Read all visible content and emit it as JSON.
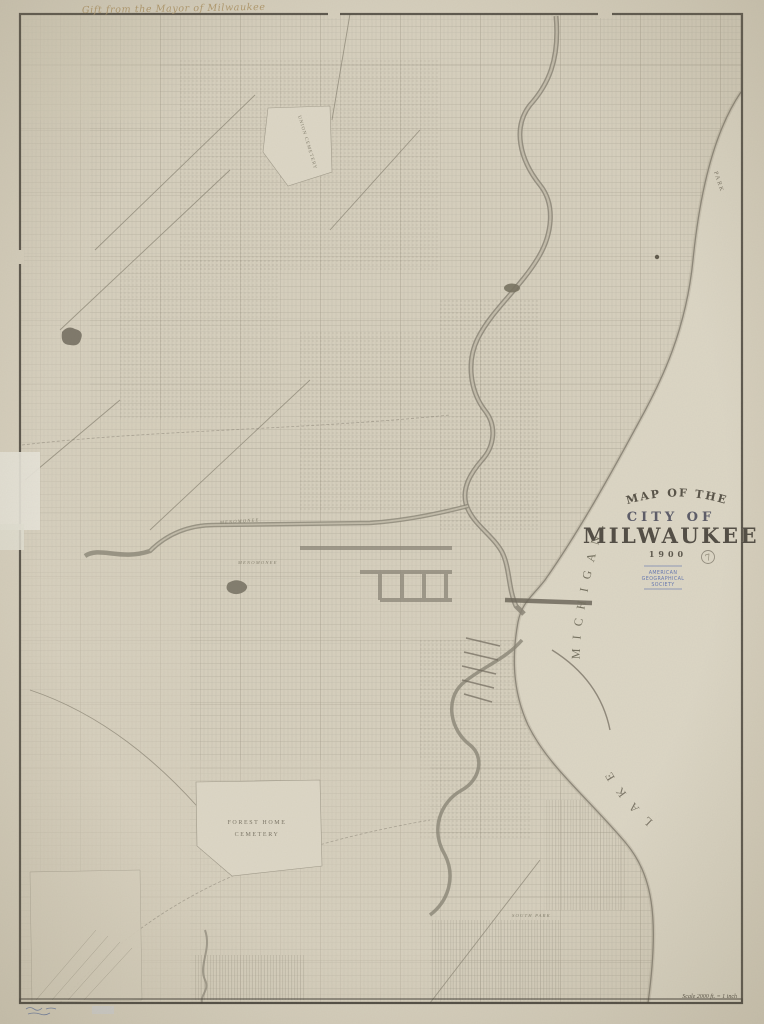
{
  "map": {
    "inscription": "Gift from the Mayor of Milwaukee",
    "title": {
      "arc": "MAP OF THE",
      "line2": "CITY OF",
      "line3": "MILWAUKEE",
      "year": "1900"
    },
    "stamp": {
      "line1": "AMERICAN",
      "line2": "GEOGRAPHICAL",
      "line3": "SOCIETY"
    },
    "pencil_number": "7",
    "scale_note": "Scale 2000 ft. = 1 inch",
    "water_labels": {
      "lake": "LAKE",
      "michigan": "MICHIGAN.",
      "park": "PARK"
    },
    "place_labels": {
      "union_cemetery": "UNION CEMETERY",
      "forest_home_line1": "FOREST HOME",
      "forest_home_line2": "CEMETERY",
      "menomonee_upper": "MENOMONEE",
      "menomonee_lower": "MENOMONEE",
      "south_park": "SOUTH PARK"
    },
    "colors": {
      "paper": "#d7d0be",
      "lake": "#dcd6c5",
      "ink": "#6b6557",
      "stamp_blue": "#5b6fae",
      "pencil": "#8d8775"
    }
  }
}
